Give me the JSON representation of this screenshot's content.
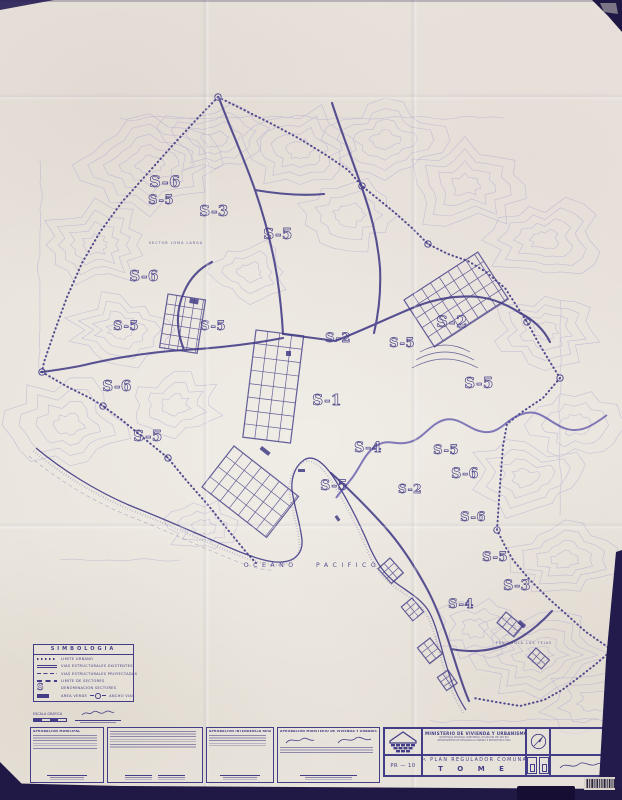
{
  "colors": {
    "paper": "#e8e3db",
    "ink": "#433c86",
    "contour": "#a89fd0",
    "river": "#5b51a8",
    "dark_edge": "#221a4b"
  },
  "legend": {
    "title": "SIMBOLOGIA",
    "rows": [
      {
        "symbol": "dotted-line",
        "label": "LIMITE URBANO"
      },
      {
        "symbol": "double-line",
        "label": "VIAS ESTRUCTURALES EXISTENTES"
      },
      {
        "symbol": "dashed-line",
        "label": "VIAS ESTRUCTURALES PROYECTADAS"
      },
      {
        "symbol": "dash-line",
        "label": "LIMITE DE SECTORES"
      },
      {
        "symbol": "sector-letter",
        "label": "DENOMINACION SECTORES"
      }
    ],
    "sector_letter": "S",
    "area_verde_label": "AREA VERDE",
    "ancho_vias_label": "ANCHO VIAS"
  },
  "scale_label": "ESCALA GRAFICA",
  "map": {
    "ocean_label": "OCEANO PACIFICO",
    "sector_labels": [
      {
        "text": "S-6",
        "x": 165,
        "y": 187,
        "size": 16
      },
      {
        "text": "S-5",
        "x": 161,
        "y": 204,
        "size": 13
      },
      {
        "text": "S-3",
        "x": 214,
        "y": 216,
        "size": 15
      },
      {
        "text": "S-5",
        "x": 278,
        "y": 239,
        "size": 15
      },
      {
        "text": "S-6",
        "x": 144,
        "y": 281,
        "size": 15
      },
      {
        "text": "S-5",
        "x": 126,
        "y": 330,
        "size": 13
      },
      {
        "text": "S-5",
        "x": 213,
        "y": 330,
        "size": 13
      },
      {
        "text": "S-2",
        "x": 338,
        "y": 342,
        "size": 13
      },
      {
        "text": "S-2",
        "x": 452,
        "y": 327,
        "size": 16
      },
      {
        "text": "S-5",
        "x": 402,
        "y": 347,
        "size": 13
      },
      {
        "text": "S-6",
        "x": 117,
        "y": 391,
        "size": 15
      },
      {
        "text": "S-1",
        "x": 327,
        "y": 405,
        "size": 15
      },
      {
        "text": "S-5",
        "x": 479,
        "y": 388,
        "size": 15
      },
      {
        "text": "S-5",
        "x": 148,
        "y": 441,
        "size": 15
      },
      {
        "text": "S-4",
        "x": 368,
        "y": 452,
        "size": 14
      },
      {
        "text": "S-5",
        "x": 446,
        "y": 454,
        "size": 13
      },
      {
        "text": "S-6",
        "x": 465,
        "y": 478,
        "size": 14
      },
      {
        "text": "S-5",
        "x": 334,
        "y": 490,
        "size": 14
      },
      {
        "text": "S-2",
        "x": 410,
        "y": 493,
        "size": 12
      },
      {
        "text": "S-6",
        "x": 473,
        "y": 521,
        "size": 13
      },
      {
        "text": "S-5",
        "x": 495,
        "y": 561,
        "size": 13
      },
      {
        "text": "S-3",
        "x": 517,
        "y": 590,
        "size": 14
      },
      {
        "text": "S-4",
        "x": 461,
        "y": 608,
        "size": 13
      }
    ],
    "place_labels": [
      {
        "text": "SECTOR LOMA LARGA",
        "x": 176,
        "y": 244
      },
      {
        "text": "PENINSULA LAS TEJAS",
        "x": 524,
        "y": 644
      }
    ]
  },
  "title_block": {
    "ministry": "MINISTERIO DE VIVIENDA Y URBANISMO",
    "sub1": "SECRETARIA REGIONAL MINISTERIAL VIII REGION DEL BIO BIO",
    "sub2": "DEPARTAMENTO DE DESARROLLO URBANO E INFRAESTRUCTURA",
    "plan_type": "PLAN REGULADOR COMUNAL",
    "commune": "T O M E",
    "sheet": "PR — 10"
  },
  "approvals": {
    "box1_title": "APROBACION MUNICIPAL",
    "box3_title": "APROBACION INTENDENCIA REGION DEL BIO - BIO",
    "box4_title": "APROBACION MINISTERIO DE VIVIENDA Y URBANISMO"
  }
}
